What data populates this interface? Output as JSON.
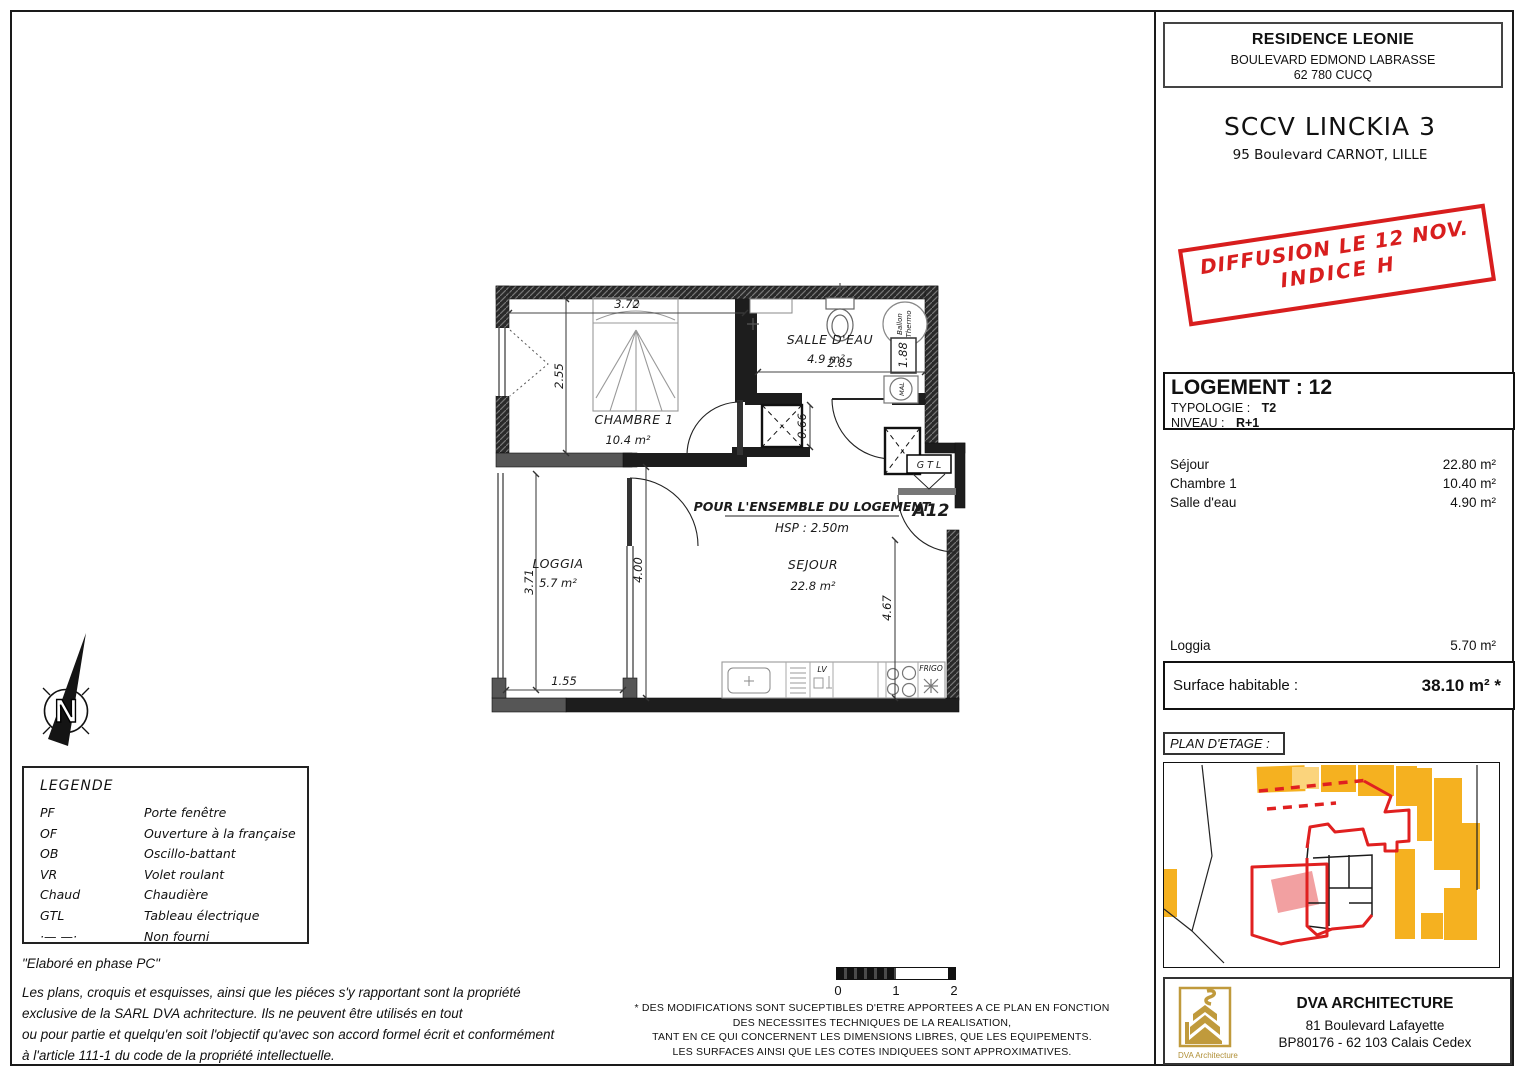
{
  "header": {
    "residence": "RESIDENCE LEONIE",
    "residence_address1": "BOULEVARD EDMOND LABRASSE",
    "residence_address2": "62 780 CUCQ",
    "company": "SCCV LINCKIA 3",
    "company_address": "95 Boulevard CARNOT, LILLE"
  },
  "stamp": {
    "line1": "DIFFUSION LE 12 NOV.",
    "line2": "INDICE H"
  },
  "logement": {
    "title": "LOGEMENT : 12",
    "typologie_label": "TYPOLOGIE :",
    "typologie_value": "T2",
    "niveau_label": "NIVEAU :",
    "niveau_value": "R+1"
  },
  "areas": {
    "rows": [
      {
        "label": "Séjour",
        "value": "22.80 m²"
      },
      {
        "label": "Chambre 1",
        "value": "10.40 m²"
      },
      {
        "label": "Salle d'eau",
        "value": "4.90 m²"
      }
    ],
    "loggia_label": "Loggia",
    "loggia_value": "5.70 m²",
    "surface_label": "Surface habitable :",
    "surface_value": "38.10 m² *"
  },
  "plan_etage": {
    "label": "PLAN D'ETAGE :"
  },
  "floorplan": {
    "rooms": {
      "chambre": {
        "name": "CHAMBRE 1",
        "area": "10.4 m²"
      },
      "salle_eau": {
        "name": "SALLE D'EAU",
        "area": "4.9 m²"
      },
      "loggia": {
        "name": "LOGGIA",
        "area": "5.7 m²"
      },
      "sejour": {
        "name": "SEJOUR",
        "area": "22.8 m²"
      }
    },
    "note1": "POUR L'ENSEMBLE DU LOGEMENT",
    "note2": "HSP : 2.50m",
    "door_label": "A12",
    "gtl": "G T L",
    "frigo": "FRIGO",
    "lv": "LV",
    "ballon1": "Ballon",
    "ballon2": "Thermo",
    "mal": "MAL",
    "dims": {
      "d372": "3.72",
      "d255": "2.55",
      "d285": "2.85",
      "d188": "1.88",
      "d066": "0.66",
      "d400": "4.00",
      "d467": "4.67",
      "d371": "3.71",
      "d155": "1.55"
    }
  },
  "compass": {
    "n": "N"
  },
  "legend": {
    "title": "LEGENDE",
    "items": [
      {
        "abbr": "PF",
        "label": "Porte fenêtre"
      },
      {
        "abbr": "OF",
        "label": "Ouverture à la française"
      },
      {
        "abbr": "OB",
        "label": "Oscillo-battant"
      },
      {
        "abbr": "VR",
        "label": "Volet roulant"
      },
      {
        "abbr": "Chaud",
        "label": "Chaudière"
      },
      {
        "abbr": "GTL",
        "label": "Tableau électrique"
      },
      {
        "abbr": "·— —·",
        "label": "Non fourni"
      }
    ]
  },
  "notes": {
    "phase": "\"Elaboré en phase PC\"",
    "copyright_lines": [
      "Les plans, croquis et esquisses, ainsi que les piéces s'y rapportant sont la propriété",
      "exclusive de la SARL DVA achritecture. Ils ne peuvent être utilisés en tout",
      "ou pour partie et quelqu'en soit l'objectif qu'avec son accord formel écrit et conformément",
      "à l'article 111-1 du code de la propriété intellectuelle."
    ]
  },
  "scalebar": {
    "t0": "0",
    "t1": "1",
    "t2": "2"
  },
  "disclaimer": {
    "lines": [
      "* DES MODIFICATIONS SONT SUCEPTIBLES D'ETRE APPORTEES A CE PLAN EN FONCTION",
      "DES NECESSITES TECHNIQUES DE LA REALISATION,",
      "TANT EN CE QUI CONCERNENT LES DIMENSIONS LIBRES, QUE LES EQUIPEMENTS.",
      "LES SURFACES AINSI QUE LES COTES INDIQUEES SONT APPROXIMATIVES."
    ]
  },
  "architect": {
    "name": "DVA ARCHITECTURE",
    "address1": "81 Boulevard Lafayette",
    "address2": "BP80176 - 62 103 Calais Cedex",
    "logo_caption": "DVA Architecture"
  },
  "colors": {
    "stamp_red": "#d81e1e",
    "map_orange": "#f5b120",
    "map_orange_light": "#fbd47c",
    "map_pink": "#f2a0a1",
    "map_red": "#e02020",
    "logo_gold": "#c09a3c",
    "wall_black": "#1d1d1d",
    "wall_gray": "#565656"
  }
}
